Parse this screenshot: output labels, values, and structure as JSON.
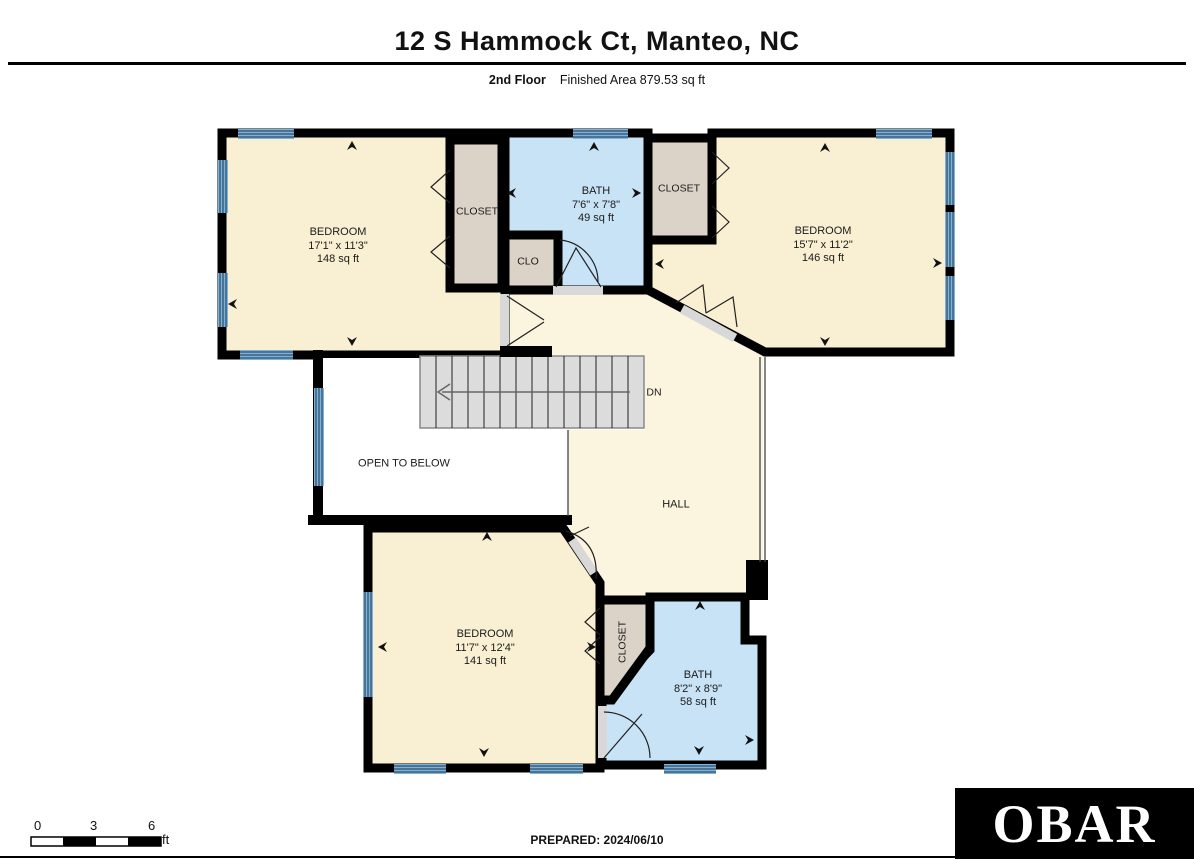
{
  "header": {
    "title": "12 S Hammock Ct, Manteo, NC",
    "floor_label": "2nd Floor",
    "area_label": "Finished Area 879.53 sq ft"
  },
  "rooms": {
    "bedroom_top_left": {
      "name": "BEDROOM",
      "dims": "17'1\" x 11'3\"",
      "area": "148 sq ft"
    },
    "closet_top_left": {
      "name": "CLOSET"
    },
    "bath_top": {
      "name": "BATH",
      "dims": "7'6\" x 7'8\"",
      "area": "49 sq ft"
    },
    "clo": {
      "name": "CLO"
    },
    "closet_top_right": {
      "name": "CLOSET"
    },
    "bedroom_top_right": {
      "name": "BEDROOM",
      "dims": "15'7\" x 11'2\"",
      "area": "146 sq ft"
    },
    "stairs": {
      "label": "DN"
    },
    "open_to_below": {
      "label": "OPEN TO BELOW"
    },
    "hall": {
      "name": "HALL"
    },
    "bedroom_bottom": {
      "name": "BEDROOM",
      "dims": "11'7\" x 12'4\"",
      "area": "141 sq ft"
    },
    "closet_bottom": {
      "name": "CLOSET"
    },
    "bath_bottom": {
      "name": "BATH",
      "dims": "8'2\" x 8'9\"",
      "area": "58 sq ft"
    }
  },
  "scale_bar": {
    "tick0": "0",
    "tick1": "3",
    "tick2": "6",
    "unit": "ft"
  },
  "footer": {
    "prepared": "PREPARED: 2024/06/10",
    "logo": "OBAR"
  },
  "colors": {
    "wall": "#000000",
    "bedroom_fill": "#F9EFD2",
    "hall_fill": "#FBF4DE",
    "bath_fill": "#C9E3F6",
    "closet_fill": "#DBD3C8",
    "window_fill": "#7FB2D8",
    "stairs_fill": "#DCDCDC",
    "door_fill": "#D8D8D8",
    "logo_bg": "#000000",
    "logo_text": "#FFFFFF"
  }
}
